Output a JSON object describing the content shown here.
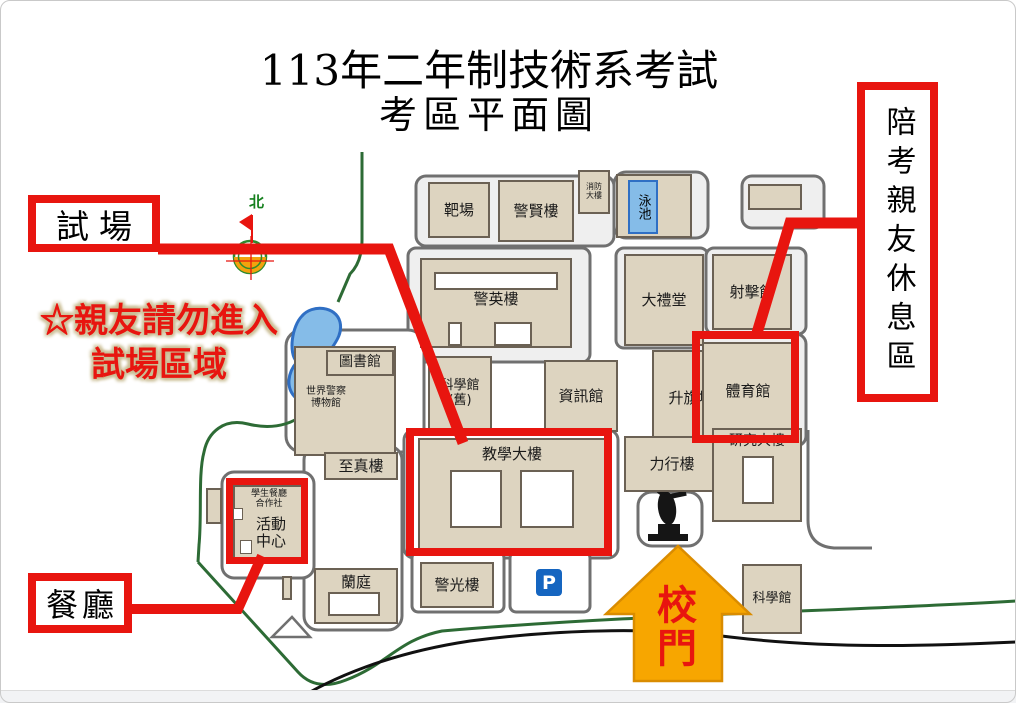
{
  "title": {
    "line1": "113年二年制技術系考試",
    "line2": "考區平面圖"
  },
  "callouts": {
    "exam_site_label": "試場",
    "restaurant_label": "餐廳",
    "rest_area_label": "陪考親友休息區",
    "warning_line1": "☆親友請勿進入",
    "warning_line2": "試場區域",
    "school_gate_label": "校門",
    "north_label": "北"
  },
  "buildings": {
    "target_range": "靶場",
    "jingxian_building": "警賢樓",
    "fire_building": "消防\n大樓",
    "swimming_pool": "泳池",
    "jingying_building": "警英樓",
    "auditorium": "大禮堂",
    "shooting_hall": "射擊館",
    "science_hall_old": "科學館\n(舊)",
    "information_hall": "資訊館",
    "flag_raising_ground": "升旗場",
    "gymnasium": "體育館",
    "library": "圖書館",
    "police_museum": "世界警察\n博物館",
    "zhizhen_building": "至真樓",
    "teaching_building": "教學大樓",
    "lixing_building": "力行樓",
    "research_building": "研究大樓",
    "student_cafeteria": "學生餐廳\n合作社",
    "activity_center": "活動\n中心",
    "lan_court": "蘭庭",
    "jingguang_building": "警光樓",
    "parking_sign": "P",
    "science_hall": "科學館"
  },
  "colors": {
    "annotation_red": "#e8150f",
    "arrow_orange": "#f7a600",
    "building_beige": "#ddd4c0",
    "pool_blue": "#85bce8",
    "path_green": "#2d6b35"
  }
}
